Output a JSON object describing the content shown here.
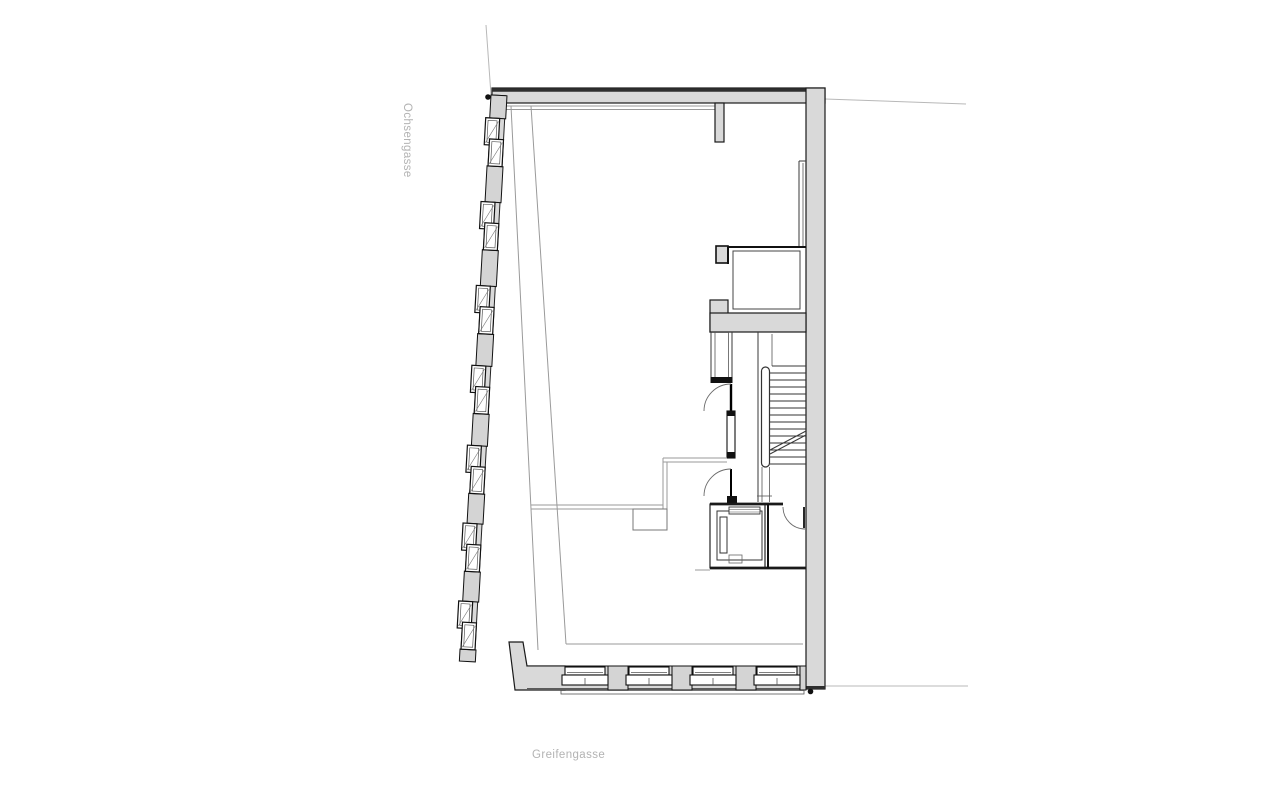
{
  "labels": {
    "street_left": "Ochsengasse",
    "street_bottom": "Greifengasse"
  },
  "colors": {
    "background": "#ffffff",
    "wall_fill": "#d9d9d9",
    "wall_outline": "#1a1a1a",
    "thin_line": "#3a3a3a",
    "partition_line": "#9a9a9a",
    "street_label_text": "#b3b3b3"
  },
  "plan": {
    "left_facade_window_units": 7,
    "bottom_facade_window_units": 4,
    "stair_tread_lines": 14,
    "survey_dots": 2
  }
}
